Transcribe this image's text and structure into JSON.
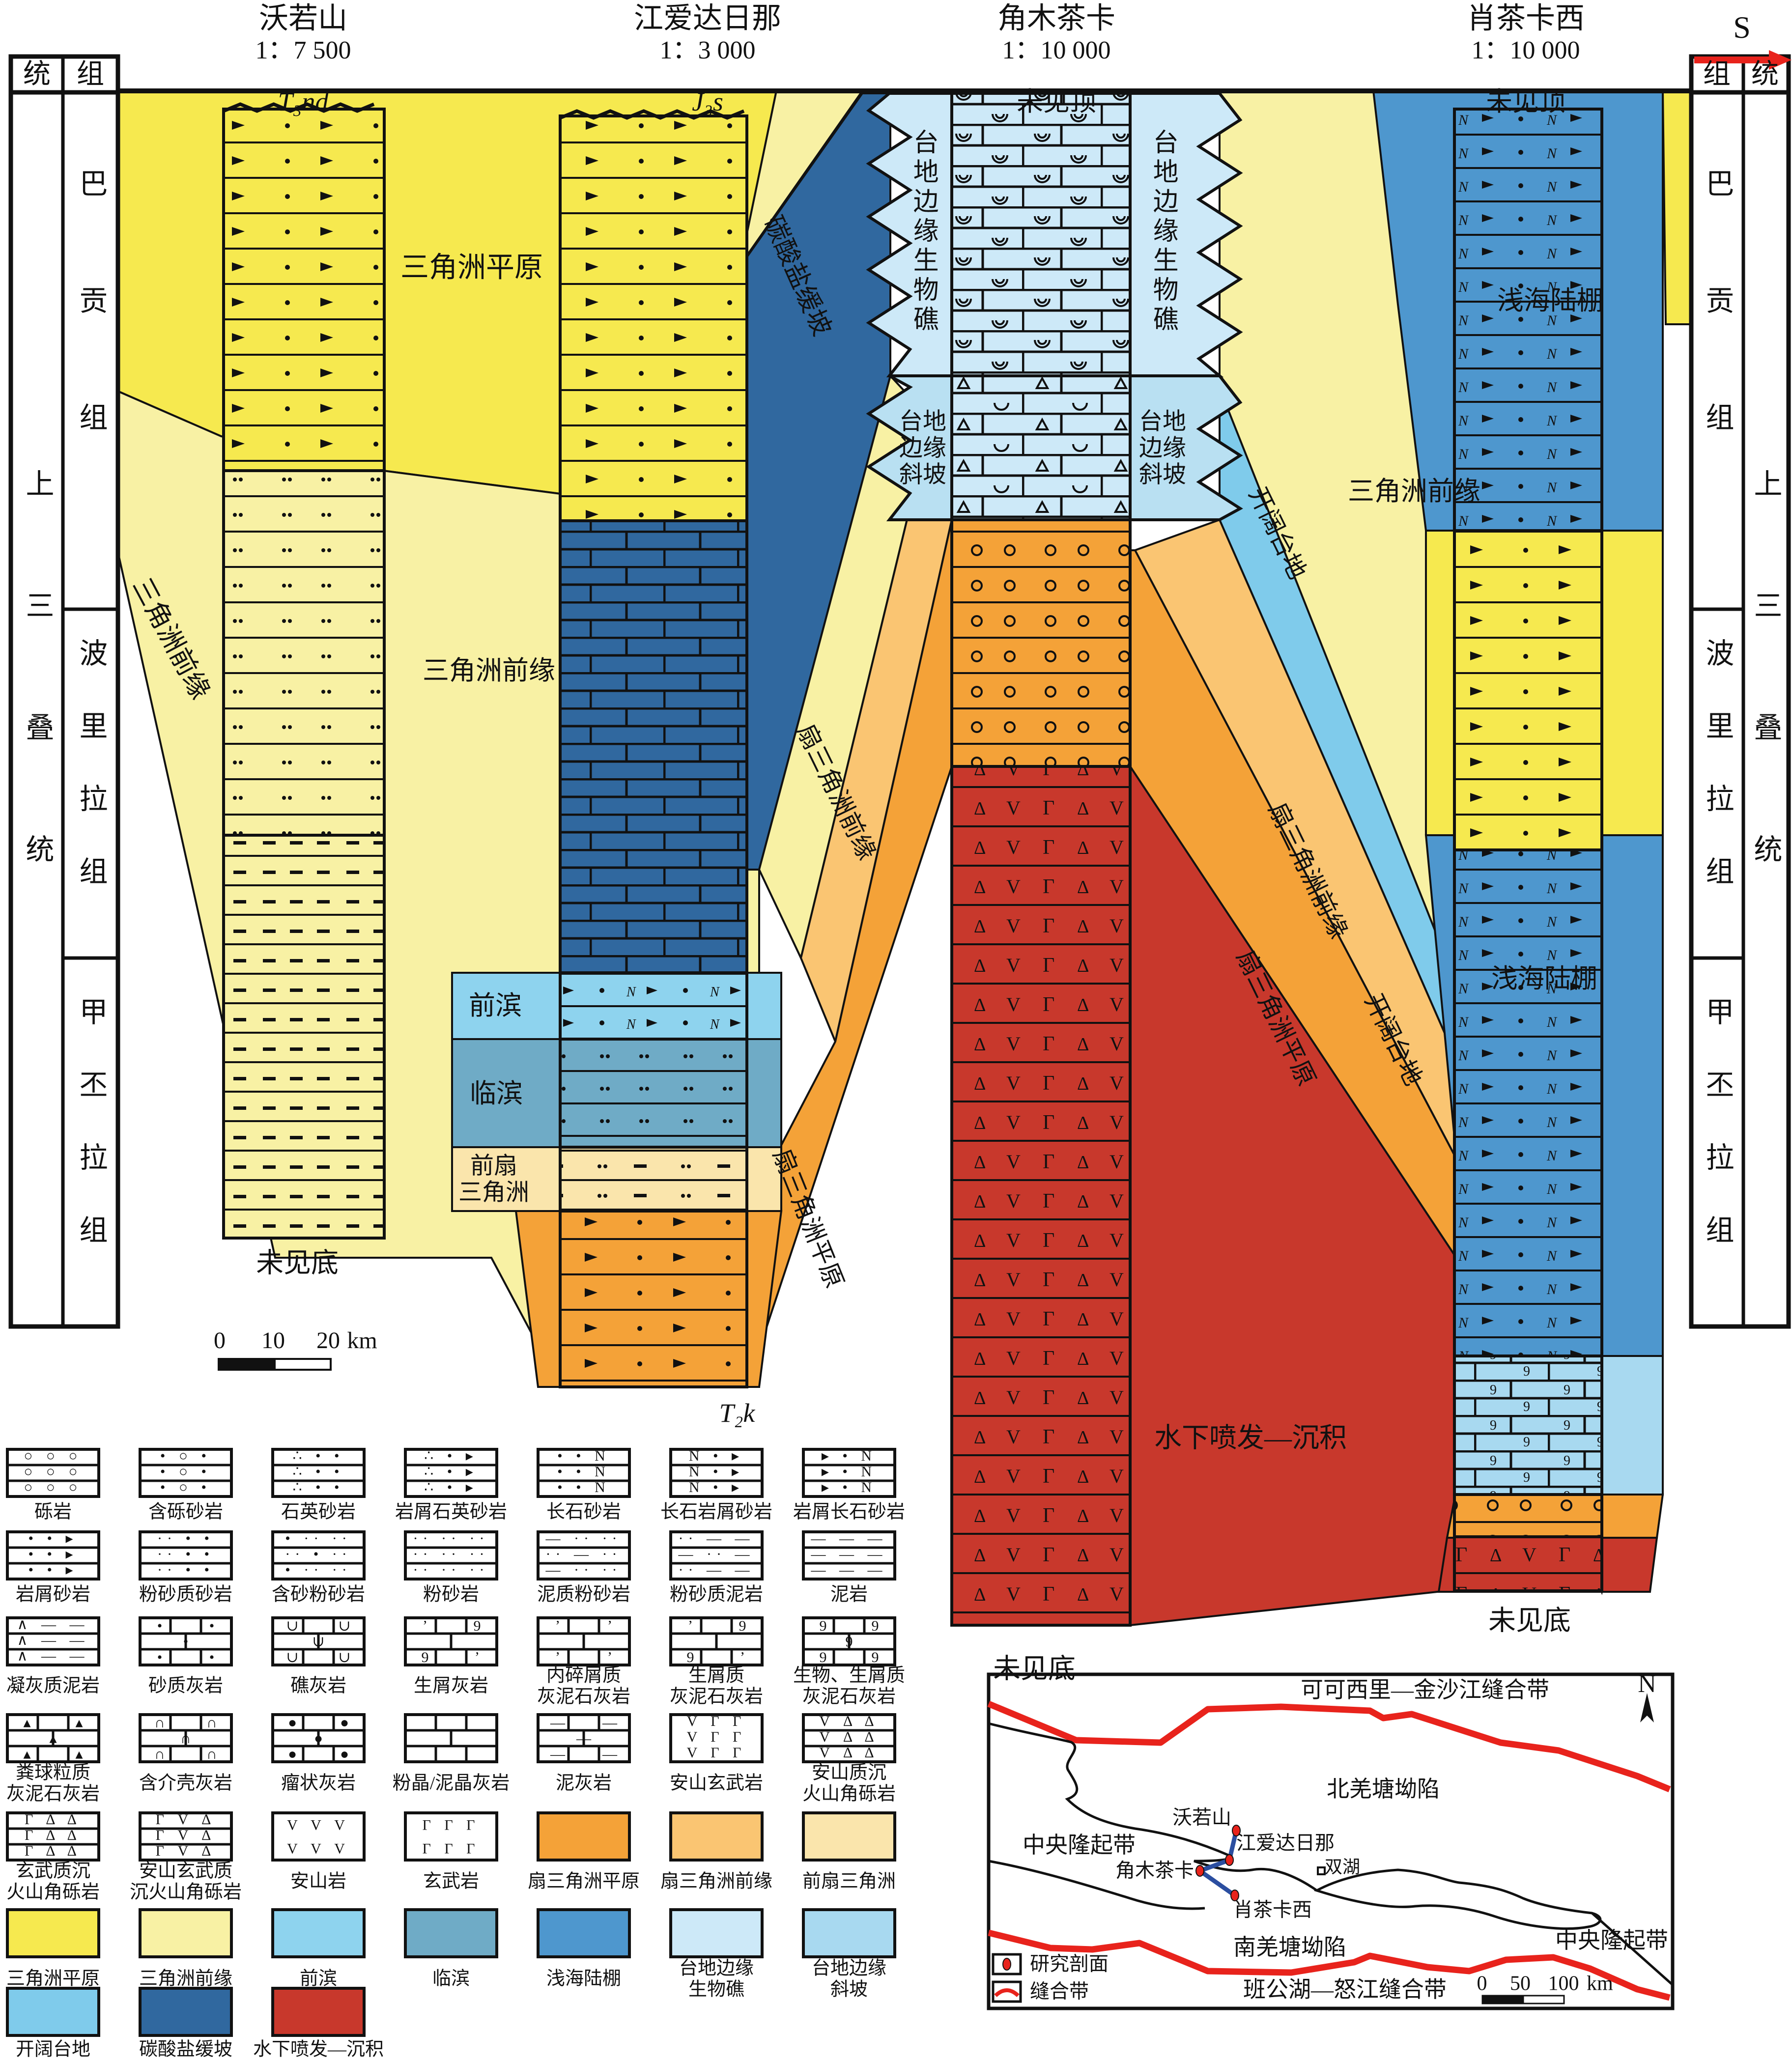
{
  "header": {
    "direction": "S",
    "sections": [
      {
        "name": "沃若山",
        "scale": "1：7 500",
        "top": "T₃nd",
        "italic": 1,
        "x": 617
      },
      {
        "name": "江爱达日那",
        "scale": "1：3 000",
        "top": "J₃s",
        "italic": 1,
        "x": 1440
      },
      {
        "name": "角木茶卡",
        "scale": "1：10 000",
        "top": "未见顶",
        "italic": 0,
        "x": 2150
      },
      {
        "name": "肖茶卡西",
        "scale": "1：10 000",
        "top": "未见顶",
        "italic": 0,
        "x": 3105
      }
    ]
  },
  "axis": {
    "left_col1": "统",
    "left_col2": "组",
    "right_col1": "组",
    "right_col2": "统",
    "series": "上三叠统",
    "formations": [
      "巴贡组",
      "波里拉组",
      "甲丕拉组"
    ]
  },
  "scalebar": {
    "ticks": [
      "0",
      "10",
      "20"
    ],
    "unit": "km",
    "x": [
      447,
      556,
      668
    ],
    "unit_x": 737,
    "y": 2729
  },
  "colors": {
    "bright_yellow": "#F6E94F",
    "pale_yellow": "#F8F1A4",
    "fan_delta_plain": "#F4A238",
    "fan_delta_front": "#FAC572",
    "prodelta": "#FAE5AC",
    "foreshore": "#8ED3EE",
    "shoreface": "#6FABC6",
    "shelf": "#4E97CE",
    "reef": "#CDE9F8",
    "slope": "#B9E0F2",
    "open_platform": "#7FCBEB",
    "carbonate_ramp": "#30689F",
    "volcanic_red": "#C8382C",
    "suture_red": "#E8231C",
    "profile_blue": "#2B4EA0"
  },
  "labels": [
    {
      "text": "统",
      "x": 75,
      "y": 152,
      "size": 56
    },
    {
      "text": "组",
      "x": 184,
      "y": 152,
      "size": 56
    },
    {
      "text": "上三叠统",
      "x": 75,
      "y": 1450,
      "size": 58,
      "vert": 1,
      "ls": 190
    },
    {
      "text": "巴贡组",
      "x": 184,
      "y": 700,
      "size": 58,
      "vert": 1,
      "ls": 180
    },
    {
      "text": "波里拉组",
      "x": 184,
      "y": 1595,
      "size": 58,
      "vert": 1,
      "ls": 90
    },
    {
      "text": "甲丕拉组",
      "x": 184,
      "y": 2325,
      "size": 58,
      "vert": 1,
      "ls": 90
    },
    {
      "text": "组",
      "x": 3494,
      "y": 152,
      "size": 56
    },
    {
      "text": "统",
      "x": 3592,
      "y": 152,
      "size": 56
    },
    {
      "text": "巴贡组",
      "x": 3494,
      "y": 700,
      "size": 58,
      "vert": 1,
      "ls": 180
    },
    {
      "text": "波里拉组",
      "x": 3494,
      "y": 1595,
      "size": 58,
      "vert": 1,
      "ls": 90
    },
    {
      "text": "甲丕拉组",
      "x": 3494,
      "y": 2325,
      "size": 58,
      "vert": 1,
      "ls": 90
    },
    {
      "text": "上三叠统",
      "x": 3592,
      "y": 1450,
      "size": 58,
      "vert": 1,
      "ls": 190
    },
    {
      "text": "三角洲平原",
      "x": 960,
      "y": 545,
      "size": 58
    },
    {
      "text": "三角洲前缘",
      "x": 348,
      "y": 1300,
      "size": 54,
      "rot": 62
    },
    {
      "text": "三角洲前缘",
      "x": 995,
      "y": 1365,
      "size": 54
    },
    {
      "text": "碳酸盐缓坡",
      "x": 1622,
      "y": 562,
      "size": 52,
      "rot": 66
    },
    {
      "text": "前滨",
      "x": 1008,
      "y": 2047,
      "size": 54
    },
    {
      "text": "临滨",
      "x": 1010,
      "y": 2226,
      "size": 54
    },
    {
      "text": "前扇\n三角洲",
      "x": 1005,
      "y": 2400,
      "size": 48
    },
    {
      "text": "扇三角洲前缘",
      "x": 1702,
      "y": 1612,
      "size": 50,
      "rot": 64
    },
    {
      "text": "扇三角洲平原",
      "x": 1645,
      "y": 2480,
      "size": 50,
      "rot": 68
    },
    {
      "text": "台地边缘生物礁",
      "x": 1878,
      "y": 472,
      "size": 52,
      "vert": 1,
      "ls": 8
    },
    {
      "text": "台地边缘生物礁",
      "x": 2366,
      "y": 472,
      "size": 52,
      "vert": 1,
      "ls": 8
    },
    {
      "text": "台地\n边缘\n斜坡",
      "x": 1878,
      "y": 912,
      "size": 48
    },
    {
      "text": "台地\n边缘\n斜坡",
      "x": 2366,
      "y": 912,
      "size": 48
    },
    {
      "text": "开阔台地",
      "x": 2600,
      "y": 1085,
      "size": 50,
      "rot": 64
    },
    {
      "text": "三角洲前缘",
      "x": 2878,
      "y": 1000,
      "size": 54
    },
    {
      "text": "扇三角洲前缘",
      "x": 2662,
      "y": 1772,
      "size": 50,
      "rot": 64
    },
    {
      "text": "扇三角洲平原",
      "x": 2597,
      "y": 2072,
      "size": 50,
      "rot": 64
    },
    {
      "text": "开阔台地",
      "x": 2836,
      "y": 2116,
      "size": 50,
      "rot": 64
    },
    {
      "text": "浅海陆棚",
      "x": 3155,
      "y": 612,
      "size": 54
    },
    {
      "text": "浅海陆棚",
      "x": 3143,
      "y": 1992,
      "size": 54
    },
    {
      "text": "水下喷发—沉积",
      "x": 2545,
      "y": 2928,
      "size": 56
    },
    {
      "text": "未见底",
      "x": 605,
      "y": 2572,
      "size": 56
    },
    {
      "text": "未见底",
      "x": 2105,
      "y": 3398,
      "size": 56
    },
    {
      "text": "未见底",
      "x": 3113,
      "y": 3300,
      "size": 56
    },
    {
      "text": "T₂k",
      "x": 1500,
      "y": 2876,
      "size": 54,
      "italic": 1
    }
  ],
  "legend": {
    "rows": [
      [
        {
          "label": "砾岩",
          "kind": "beds",
          "rows": [
            "○ ○ ○",
            "○ ○ ○",
            "○ ○ ○"
          ]
        },
        {
          "label": "含砾砂岩",
          "kind": "beds",
          "rows": [
            "• ○ •",
            "• ○ •",
            "• ○ •"
          ]
        },
        {
          "label": "石英砂岩",
          "kind": "beds",
          "rows": [
            "∴ • •",
            "∴ • •",
            "∴ • •"
          ]
        },
        {
          "label": "岩屑石英砂岩",
          "kind": "beds",
          "rows": [
            "∴ • ▸",
            "∴ • ▸",
            "∴ • ▸"
          ]
        },
        {
          "label": "长石砂岩",
          "kind": "beds",
          "rows": [
            "• • N",
            "• • N",
            "• • N"
          ]
        },
        {
          "label": "长石岩屑砂岩",
          "kind": "beds",
          "rows": [
            "N • ▸",
            "N • ▸",
            "N • ▸"
          ]
        },
        {
          "label": "岩屑长石砂岩",
          "kind": "beds",
          "rows": [
            "▸ • N",
            "▸ • N",
            "▸ • N"
          ]
        }
      ],
      [
        {
          "label": "岩屑砂岩",
          "kind": "beds",
          "rows": [
            "• • ▸",
            "• • ▸",
            "• • ▸"
          ]
        },
        {
          "label": "粉砂质砂岩",
          "kind": "beds",
          "rows": [
            "·· • •",
            "·· • •",
            "·· • •"
          ]
        },
        {
          "label": "含砂粉砂岩",
          "kind": "beds",
          "rows": [
            "• ·· ··",
            "·· • ··",
            "• ·· ··"
          ]
        },
        {
          "label": "粉砂岩",
          "kind": "beds",
          "rows": [
            "·· ·· ··",
            "·· ·· ··",
            "·· ·· ··"
          ]
        },
        {
          "label": "泥质粉砂岩",
          "kind": "beds",
          "rows": [
            "— ·· ··",
            "·· — ··",
            "— ·· ··"
          ]
        },
        {
          "label": "粉砂质泥岩",
          "kind": "beds",
          "rows": [
            "·· — —",
            "— ·· —",
            "·· — —"
          ]
        },
        {
          "label": "泥岩",
          "kind": "beds",
          "rows": [
            "— — —",
            "— — —",
            "— — —"
          ]
        }
      ],
      [
        {
          "label": "凝灰质泥岩",
          "kind": "beds",
          "rows": [
            "∧ — —",
            "∧ — —",
            "∧ — —"
          ]
        },
        {
          "label": "砂质灰岩",
          "kind": "brick",
          "sym": "•"
        },
        {
          "label": "礁灰岩",
          "kind": "brick",
          "sym": "∪"
        },
        {
          "label": "生屑灰岩",
          "kind": "brick",
          "sym": "ʼ9"
        },
        {
          "label": "内碎屑质\n灰泥石灰岩",
          "kind": "brick",
          "sym": "ʼ"
        },
        {
          "label": "生屑质\n灰泥石灰岩",
          "kind": "brick",
          "sym": "ʼ9"
        },
        {
          "label": "生物、生屑质\n灰泥石灰岩",
          "kind": "brick",
          "sym": "99"
        }
      ],
      [
        {
          "label": "粪球粒质\n灰泥石灰岩",
          "kind": "brick",
          "sym": "▴"
        },
        {
          "label": "含介壳灰岩",
          "kind": "brick",
          "sym": "∩"
        },
        {
          "label": "瘤状灰岩",
          "kind": "brick",
          "sym": "●"
        },
        {
          "label": "粉晶/泥晶灰岩",
          "kind": "brick",
          "sym": ""
        },
        {
          "label": "泥灰岩",
          "kind": "brick",
          "sym": "—"
        },
        {
          "label": "安山玄武岩",
          "kind": "beds",
          "nolines": 1,
          "rows": [
            "V Γ Γ",
            "V Γ Γ",
            "V Γ Γ"
          ]
        },
        {
          "label": "安山质沉\n火山角砾岩",
          "kind": "beds",
          "rows": [
            "V Δ Δ",
            "V Δ Δ",
            "V Δ Δ"
          ]
        }
      ],
      [
        {
          "label": "玄武质沉\n火山角砾岩",
          "kind": "beds",
          "rows": [
            "Γ Δ Δ",
            "Γ Δ Δ",
            "Γ Δ Δ"
          ]
        },
        {
          "label": "安山玄武质\n沉火山角砾岩",
          "kind": "beds",
          "rows": [
            "Γ V Δ",
            "Γ V Δ",
            "Γ V Δ"
          ]
        },
        {
          "label": "安山岩",
          "kind": "beds",
          "nolines": 1,
          "rows": [
            "V V V",
            "V V V"
          ]
        },
        {
          "label": "玄武岩",
          "kind": "beds",
          "nolines": 1,
          "rows": [
            "Γ Γ Γ",
            "Γ Γ Γ"
          ]
        },
        {
          "label": "扇三角洲平原",
          "kind": "color",
          "color": "#F4A238"
        },
        {
          "label": "扇三角洲前缘",
          "kind": "color",
          "color": "#FAC572"
        },
        {
          "label": "前扇三角洲",
          "kind": "color",
          "color": "#FAE5AC"
        }
      ],
      [
        {
          "label": "三角洲平原",
          "kind": "color",
          "color": "#F6E94F"
        },
        {
          "label": "三角洲前缘",
          "kind": "color",
          "color": "#F8F1A4"
        },
        {
          "label": "前滨",
          "kind": "color",
          "color": "#8ED3EE"
        },
        {
          "label": "临滨",
          "kind": "color",
          "color": "#6FABC6"
        },
        {
          "label": "浅海陆棚",
          "kind": "color",
          "color": "#4E97CE"
        },
        {
          "label": "台地边缘\n生物礁",
          "kind": "color",
          "color": "#CDE9F8"
        },
        {
          "label": "台地边缘\n斜坡",
          "kind": "color",
          "color": "#A8D9F0"
        }
      ],
      [
        {
          "label": "开阔台地",
          "kind": "color",
          "color": "#7FCBEB"
        },
        {
          "label": "碳酸盐缓坡",
          "kind": "color",
          "color": "#30689F"
        },
        {
          "label": "水下喷发—沉积",
          "kind": "color",
          "color": "#C8382C"
        }
      ]
    ]
  },
  "inset_map": {
    "labels": [
      {
        "text": "可可西里—金沙江缝合带",
        "x": 2900,
        "y": 3440,
        "size": 46
      },
      {
        "text": "N",
        "x": 3352,
        "y": 3428,
        "size": 52
      },
      {
        "text": "北羌塘坳陷",
        "x": 2815,
        "y": 3642,
        "size": 46
      },
      {
        "text": "中央隆起带",
        "x": 2196,
        "y": 3756,
        "size": 46
      },
      {
        "text": "沃若山",
        "x": 2446,
        "y": 3700,
        "size": 40
      },
      {
        "text": "江爱达日那",
        "x": 2616,
        "y": 3752,
        "size": 40
      },
      {
        "text": "角木茶卡",
        "x": 2350,
        "y": 3808,
        "size": 40
      },
      {
        "text": "双湖",
        "x": 2732,
        "y": 3800,
        "size": 36
      },
      {
        "text": "肖茶卡西",
        "x": 2590,
        "y": 3888,
        "size": 40
      },
      {
        "text": "南羌塘坳陷",
        "x": 2625,
        "y": 3964,
        "size": 46
      },
      {
        "text": "中央隆起带",
        "x": 3280,
        "y": 3950,
        "size": 46
      },
      {
        "text": "班公湖—怒江缝合带",
        "x": 2737,
        "y": 4050,
        "size": 46
      },
      {
        "text": "研究剖面",
        "x": 2176,
        "y": 3998,
        "size": 40
      },
      {
        "text": "缝合带",
        "x": 2156,
        "y": 4054,
        "size": 40
      }
    ],
    "scale": {
      "ticks": [
        "0",
        "50",
        "100"
      ],
      "unit": "km",
      "x": [
        3016,
        3094,
        3182
      ],
      "unit_x": 3256,
      "y": 4038
    }
  }
}
